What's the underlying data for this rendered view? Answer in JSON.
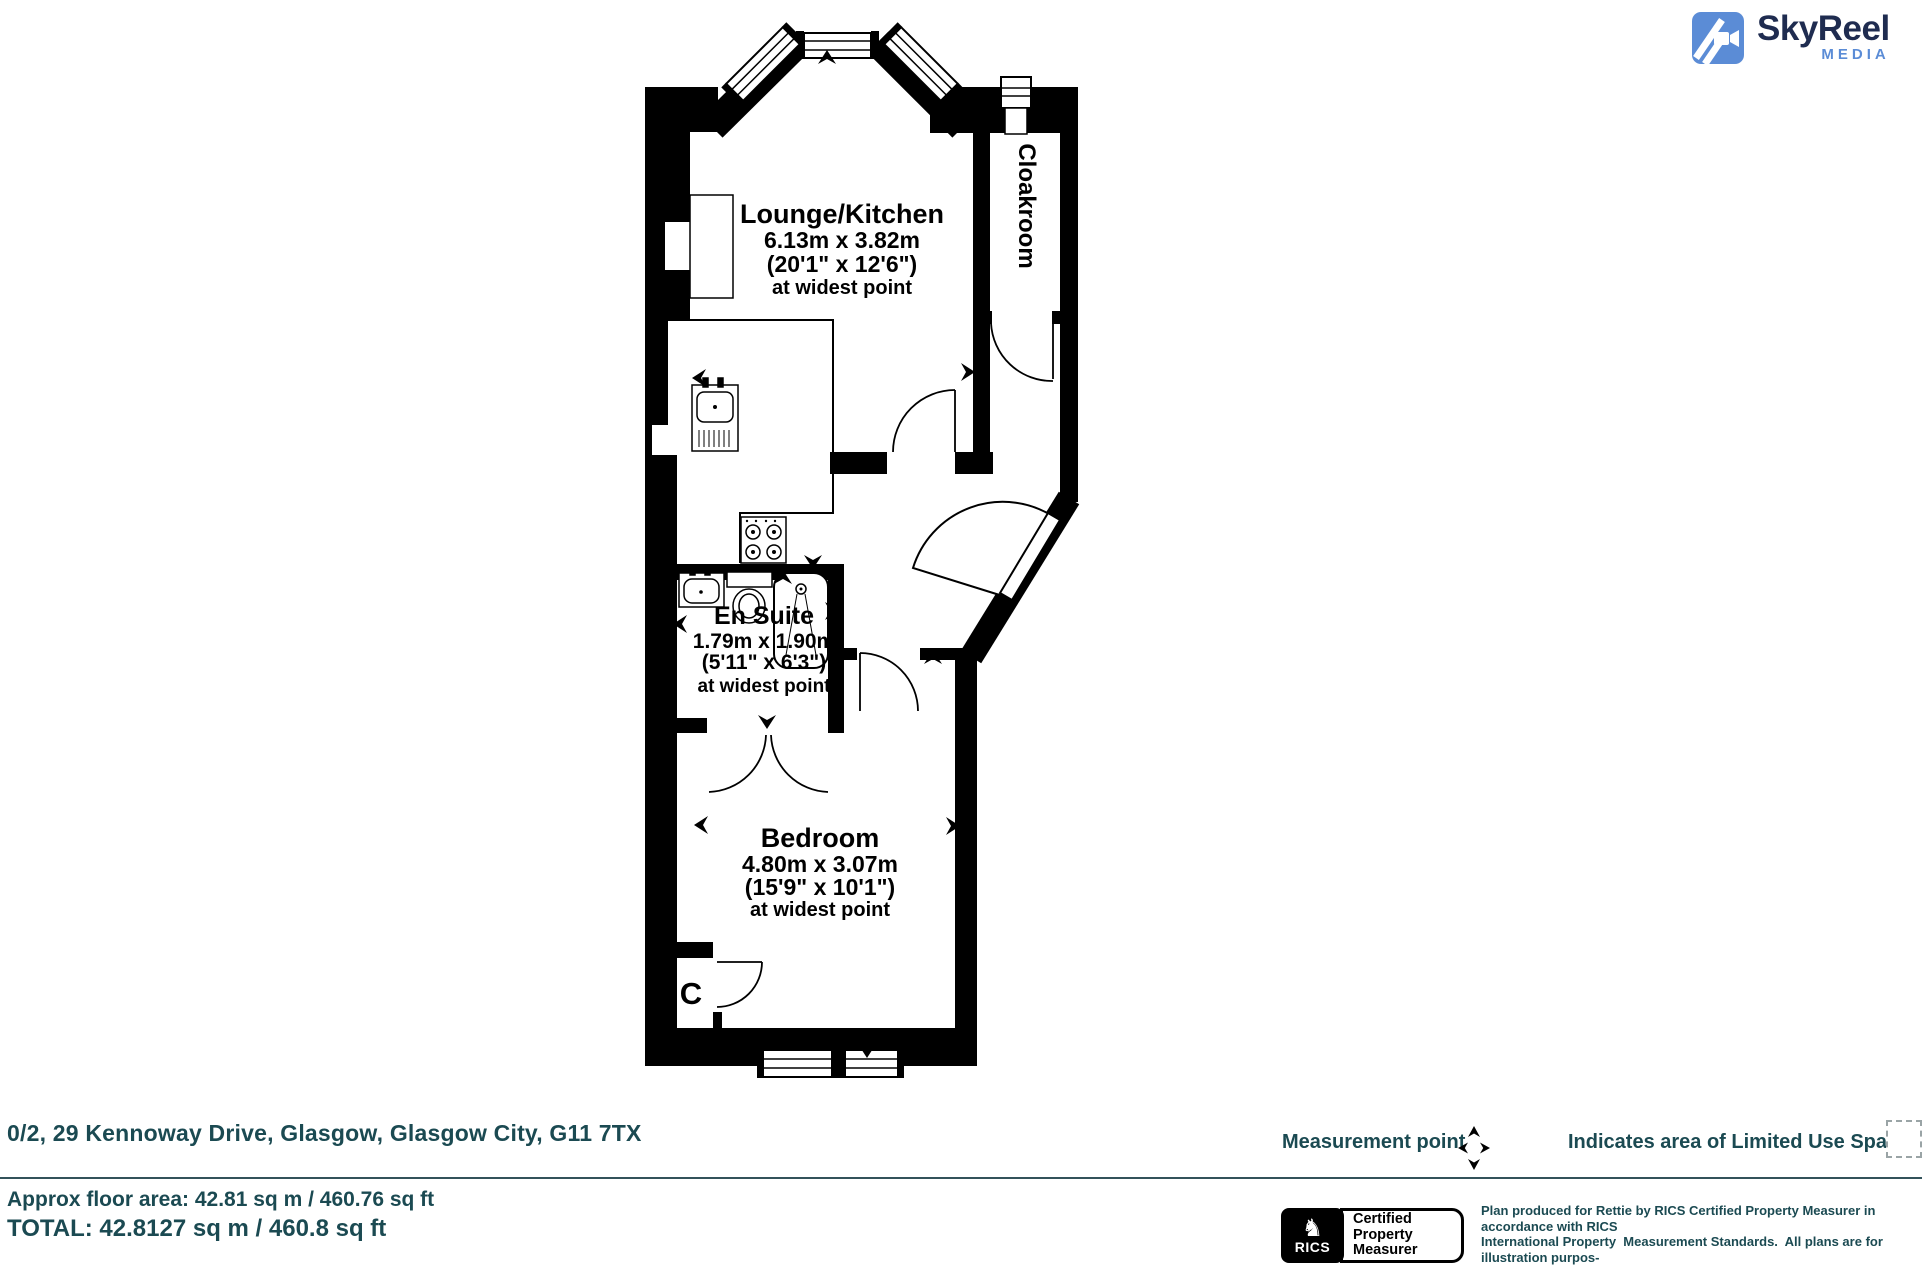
{
  "brand": {
    "name": "SkyReel",
    "tagline": "MEDIA"
  },
  "plan": {
    "lounge_kitchen": {
      "title": "Lounge/Kitchen",
      "metric": "6.13m x 3.82m",
      "imperial": "(20'1\" x 12'6\")",
      "note": "at widest point"
    },
    "cloakroom": {
      "title": "Cloakroom"
    },
    "en_suite": {
      "title": "En Suite",
      "metric": "1.79m x 1.90m",
      "imperial": "(5'11\" x 6'3\")",
      "note": "at widest point"
    },
    "bedroom": {
      "title": "Bedroom",
      "metric": "4.80m x 3.07m",
      "imperial": "(15'9\" x 10'1\")",
      "note": "at widest point"
    },
    "cupboard": {
      "label": "C"
    }
  },
  "footer": {
    "address": "0/2, 29 Kennoway Drive, Glasgow, Glasgow City, G11 7TX",
    "approx_area": "Approx floor area: 42.81 sq m / 460.76 sq ft",
    "total_area": "TOTAL: 42.8127 sq m / 460.8 sq ft",
    "measurement_point_label": "Measurement point",
    "limited_use_label": "Indicates area of  Limited Use Space",
    "rics_badge": {
      "brand": "RICS",
      "cert_line1": "Certified",
      "cert_line2": "Property",
      "cert_line3": "Measurer"
    },
    "disclaimer_lines": [
      "Plan produced for Rettie by RICS Certified Property Measurer in accordance with RICS",
      "International Property  Measurement Standards.  All plans are for illustration purpos-",
      "es and should not be relied upon as statement of fact Measurements shown are taken",
      "from points indicated. Areas with curved and angled walls are approximated."
    ]
  },
  "colors": {
    "teal": "#1b4a52",
    "logo_blue": "#5b8cd6",
    "logo_navy": "#1f2c50",
    "plan_black": "#000000"
  }
}
